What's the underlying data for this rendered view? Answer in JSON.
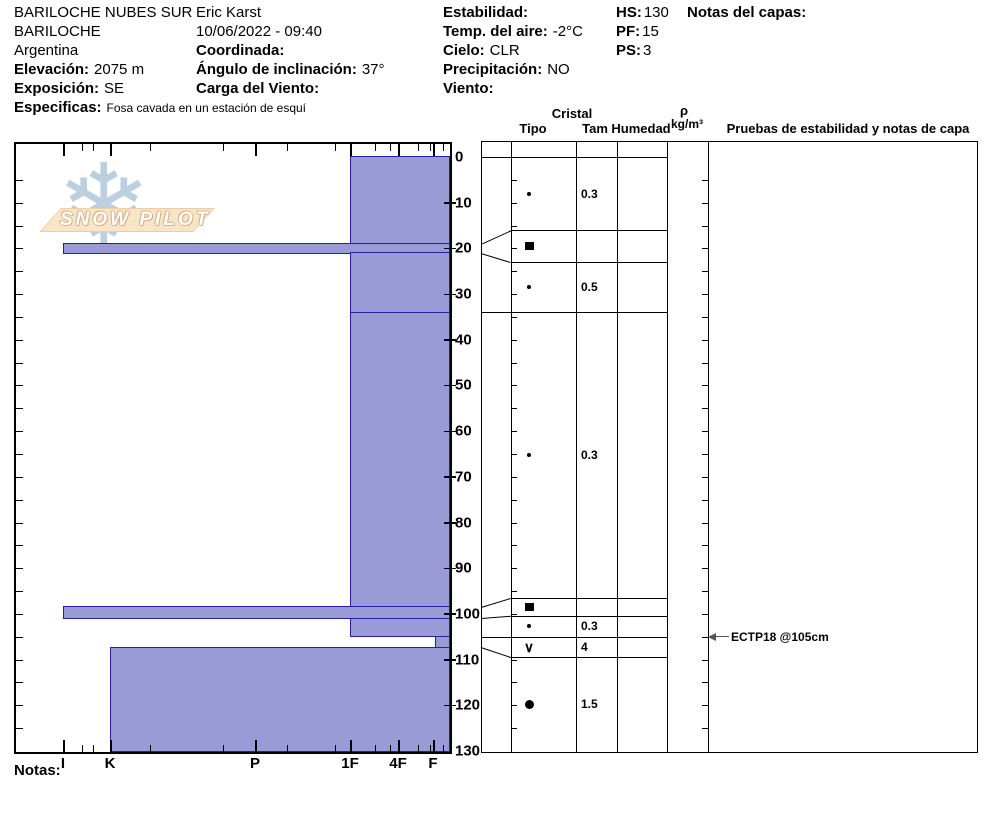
{
  "header": {
    "site": "BARILOCHE NUBES SUR",
    "observer": "Eric Karst",
    "region": "BARILOCHE",
    "datetime": "10/06/2022 - 09:40",
    "country": "Argentina",
    "coordinada_label": "Coordinada:",
    "elevacion_label": "Elevación:",
    "elevacion_value": "2075 m",
    "angulo_label": "Ángulo de inclinación:",
    "angulo_value": "37°",
    "exposicion_label": "Exposición:",
    "exposicion_value": "SE",
    "carga_label": "Carga del Viento:",
    "especificas_label": "Especificas:",
    "especificas_value": "Fosa cavada en un estación de esquí",
    "estabilidad_label": "Estabilidad:",
    "temp_label": "Temp. del aire:",
    "temp_value": "-2°C",
    "cielo_label": "Cielo:",
    "cielo_value": "CLR",
    "precipitacion_label": "Precipitación:",
    "precipitacion_value": "NO",
    "viento_label": "Viento:",
    "hs_label": "HS:",
    "hs_value": "130",
    "pf_label": "PF:",
    "pf_value": "15",
    "ps_label": "PS:",
    "ps_value": "3",
    "notas_capas_label": "Notas del capas:"
  },
  "logo": {
    "text": "SNOW PILOT",
    "snowflake_icon": "❄"
  },
  "table_header": {
    "cristal": "Cristal",
    "tipo": "Tipo",
    "tam": "Tam",
    "humedad": "Humedad",
    "rho": "ρ",
    "rho_units": "kg/m³",
    "pruebas": "Pruebas de estabilidad y notas de capa"
  },
  "footer": {
    "notas_label": "Notas:"
  },
  "chart_data": {
    "type": "bar",
    "subtype": "snow-hardness-profile",
    "title": "Snow pit hardness profile with grain type, size and stability tests",
    "depth_unit": "cm",
    "depth_range": [
      0,
      130
    ],
    "depth_ticks": [
      0,
      10,
      20,
      30,
      40,
      50,
      60,
      70,
      80,
      90,
      100,
      110,
      120,
      130
    ],
    "hardness_axis": [
      "I",
      "K",
      "P",
      "1F",
      "4F",
      "F"
    ],
    "legend_position": "none",
    "grid": false,
    "layers": [
      {
        "top_cm": 0,
        "bottom_cm": 19,
        "hardness": "1F",
        "grain_symbol": "dot",
        "grain_name": "small-grains",
        "size_mm": "0.3",
        "row_top": 0,
        "row_bottom": 16
      },
      {
        "top_cm": 19,
        "bottom_cm": 21,
        "hardness": "I",
        "grain_symbol": "square",
        "grain_name": "ice-crust",
        "size_mm": "",
        "row_top": 16,
        "row_bottom": 23
      },
      {
        "top_cm": 21,
        "bottom_cm": 34,
        "hardness": "1F",
        "grain_symbol": "dot",
        "grain_name": "small-grains",
        "size_mm": "0.5",
        "row_top": 23,
        "row_bottom": 34
      },
      {
        "top_cm": 34,
        "bottom_cm": 98.5,
        "hardness": "1F",
        "grain_symbol": "dot",
        "grain_name": "small-grains",
        "size_mm": "0.3",
        "row_top": 34,
        "row_bottom": 96.5
      },
      {
        "top_cm": 98.5,
        "bottom_cm": 101,
        "hardness": "I",
        "grain_symbol": "square",
        "grain_name": "ice-crust",
        "size_mm": "",
        "row_top": 96.5,
        "row_bottom": 100.5
      },
      {
        "top_cm": 101,
        "bottom_cm": 105,
        "hardness": "1F",
        "grain_symbol": "dot",
        "grain_name": "small-grains",
        "size_mm": "0.3",
        "row_top": 100.5,
        "row_bottom": 105
      },
      {
        "top_cm": 105,
        "bottom_cm": 107.3,
        "hardness": "F-",
        "grain_symbol": "vee",
        "grain_name": "surface-hoar",
        "size_mm": "4",
        "row_top": 105,
        "row_bottom": 109.5
      },
      {
        "top_cm": 107.3,
        "bottom_cm": 130,
        "hardness": "K",
        "grain_symbol": "circle",
        "grain_name": "rounds",
        "size_mm": "1.5",
        "row_top": 109.5,
        "row_bottom": 130
      }
    ],
    "stability_tests": [
      {
        "label": "ECTP18 @105cm",
        "depth_cm": 105
      }
    ],
    "colors": {
      "layer_fill": "#9a9ad6",
      "layer_border": "#2121a3",
      "axis": "#000000",
      "snowflake": "#bccfdf",
      "badge": "#f8e4c6"
    }
  }
}
